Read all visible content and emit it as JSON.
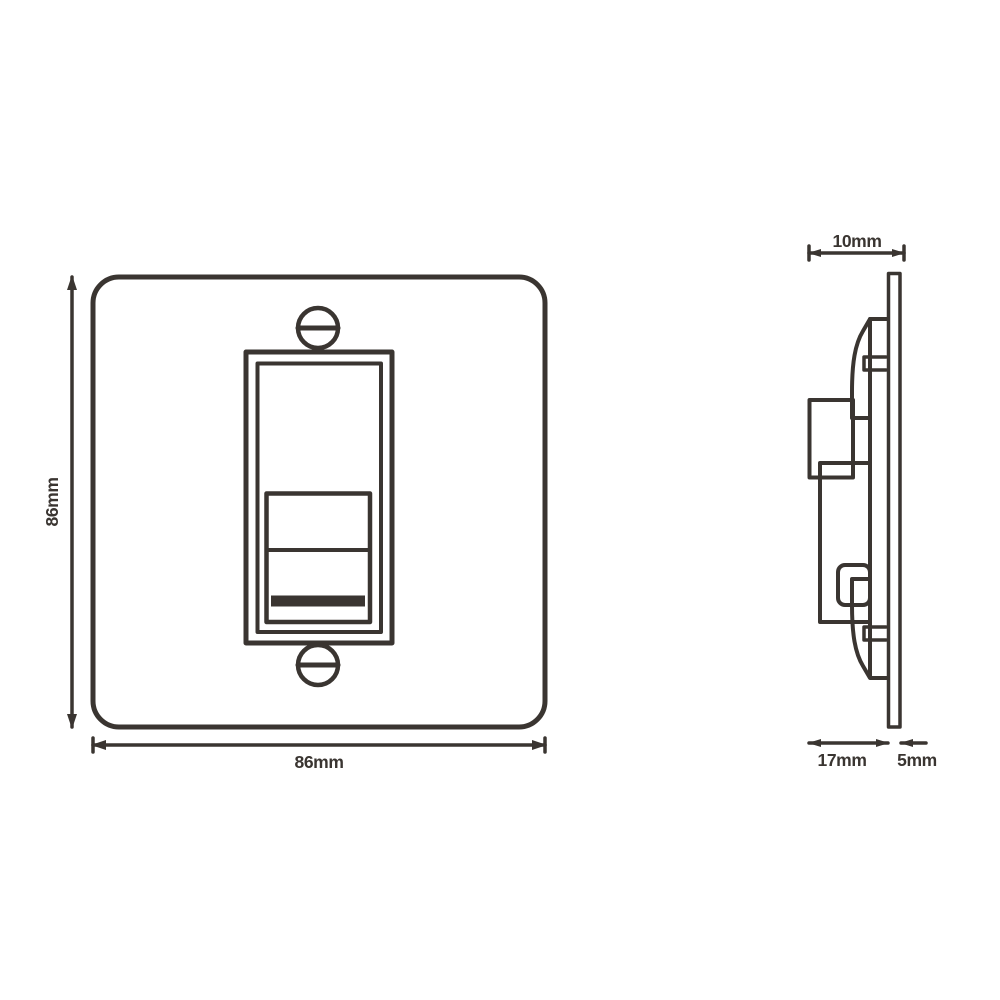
{
  "drawing": {
    "type": "technical-dimension-drawing",
    "subject": "single-gang flat plate socket outlet, front and side elevation",
    "colors": {
      "line": "#3a3531",
      "background": "#ffffff"
    }
  },
  "dimensions": {
    "front_height": "86mm",
    "front_width": "86mm",
    "total_depth": "10mm",
    "module_depth": "17mm",
    "plate_thickness": "5mm"
  }
}
